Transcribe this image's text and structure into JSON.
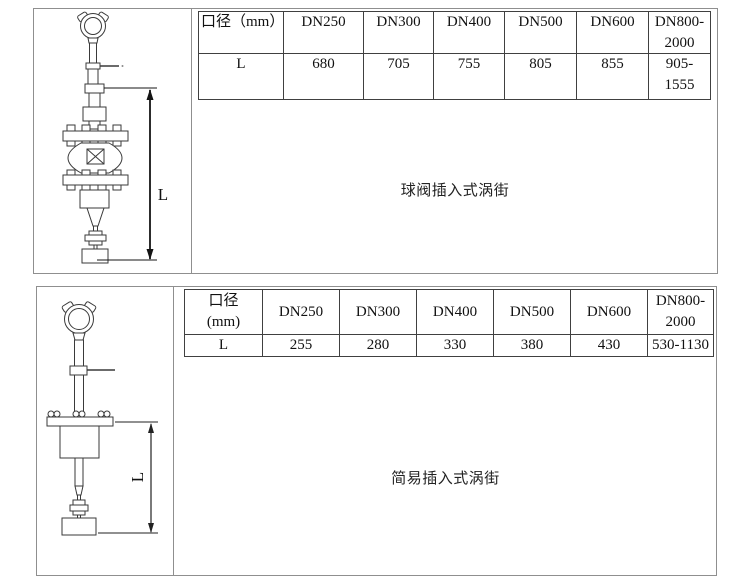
{
  "colors": {
    "panel_border": "#8f8f8f",
    "table_border": "#404040",
    "line_art": "#3a3a3a",
    "dimension_line": "#141414"
  },
  "sections": [
    {
      "id": "ball-valve-insertion",
      "caption": "球阀插入式涡街",
      "dimension_label": "L",
      "table": {
        "headers": [
          "口径（mm）",
          "DN250",
          "DN300",
          "DN400",
          "DN500",
          "DN600",
          "DN800-2000"
        ],
        "rows": [
          [
            "L",
            "680",
            "705",
            "755",
            "805",
            "855",
            "905-1555"
          ]
        ]
      }
    },
    {
      "id": "simple-insertion",
      "caption": "简易插入式涡街",
      "dimension_label": "L",
      "table": {
        "headers": [
          "口径\n(mm)",
          "DN250",
          "DN300",
          "DN400",
          "DN500",
          "DN600",
          "DN800-2000"
        ],
        "rows": [
          [
            "L",
            "255",
            "280",
            "330",
            "380",
            "430",
            "530-1130"
          ]
        ]
      }
    }
  ]
}
